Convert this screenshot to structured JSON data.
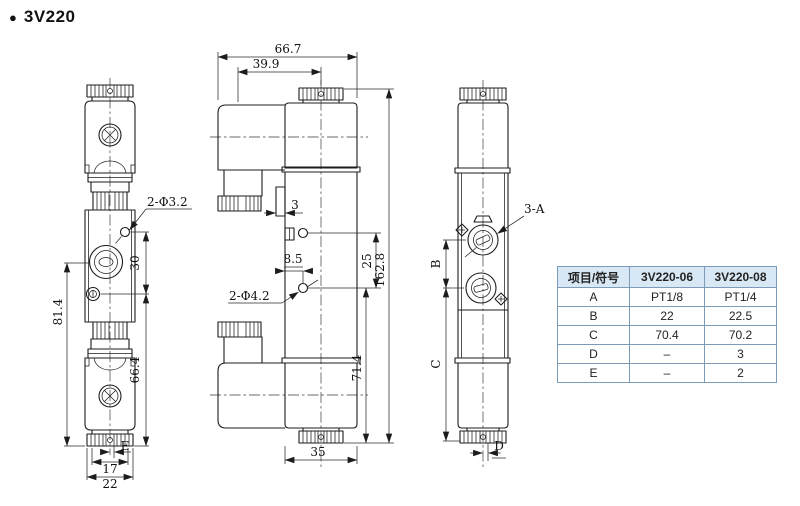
{
  "title": {
    "bullet": "●",
    "text": "3V220"
  },
  "views": {
    "front": {
      "labels": {
        "hole": "2-Φ3.2",
        "d30": "30",
        "d81_4": "81.4",
        "d66_4": "66.4",
        "dE": "E",
        "d17": "17",
        "d22": "22"
      }
    },
    "side": {
      "labels": {
        "d66_7": "66.7",
        "d39_9": "39.9",
        "d3": "3",
        "d8_5": "8.5",
        "hole": "2-Φ4.2",
        "d25": "25",
        "d162_8": "162.8",
        "d71_4": "71.4",
        "d35": "35"
      }
    },
    "back": {
      "labels": {
        "port": "3-A",
        "dB": "B",
        "dC": "C",
        "dD": "D"
      }
    }
  },
  "table": {
    "headers": [
      "项目/符号",
      "3V220-06",
      "3V220-08"
    ],
    "rows": [
      [
        "A",
        "PT1/8",
        "PT1/4"
      ],
      [
        "B",
        "22",
        "22.5"
      ],
      [
        "C",
        "70.4",
        "70.2"
      ],
      [
        "D",
        "–",
        "3"
      ],
      [
        "E",
        "–",
        "2"
      ]
    ],
    "header_bg": "#d8e8f5",
    "border_color": "#7d9cba"
  },
  "drawing": {
    "line_color": "#1c1c1c",
    "background": "#ffffff"
  }
}
